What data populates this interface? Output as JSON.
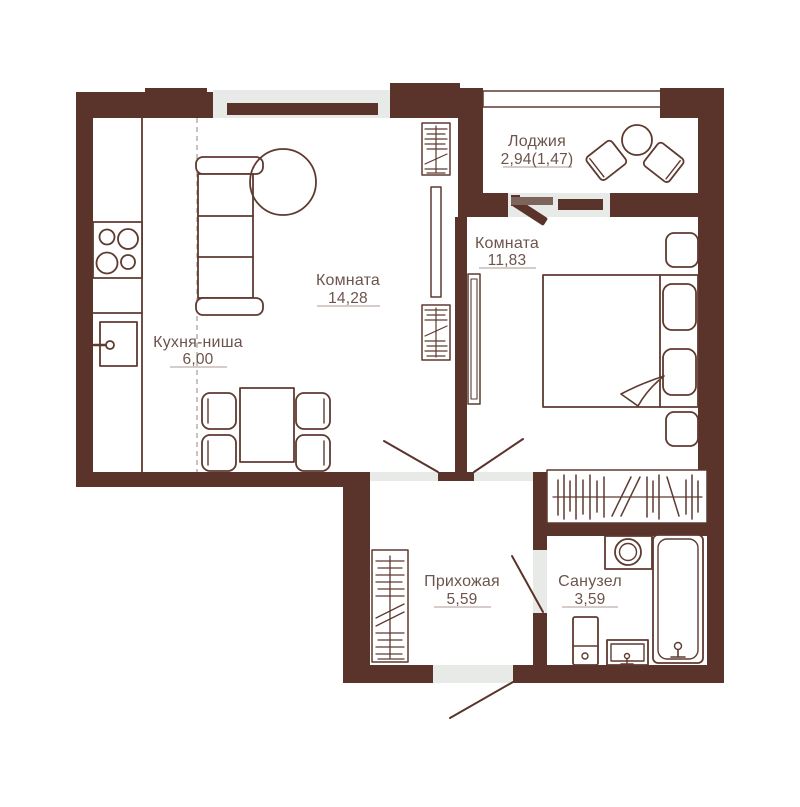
{
  "colors": {
    "wall": "#5a332b",
    "line": "#5e3a30",
    "label": "#6d544c",
    "underline": "#bfaea6",
    "threshold": "#e8eae7",
    "door_frame": "#7d655b",
    "dashed": "#b3a9a2"
  },
  "rooms": [
    {
      "name": "Комната",
      "area": "14,28"
    },
    {
      "name": "Кухня-ниша",
      "area": "6,00"
    },
    {
      "name": "Лоджия",
      "area": "2,94(1,47)"
    },
    {
      "name": "Комната",
      "area": "11,83"
    },
    {
      "name": "Прихожая",
      "area": "5,59"
    },
    {
      "name": "Санузел",
      "area": "3,59"
    }
  ]
}
